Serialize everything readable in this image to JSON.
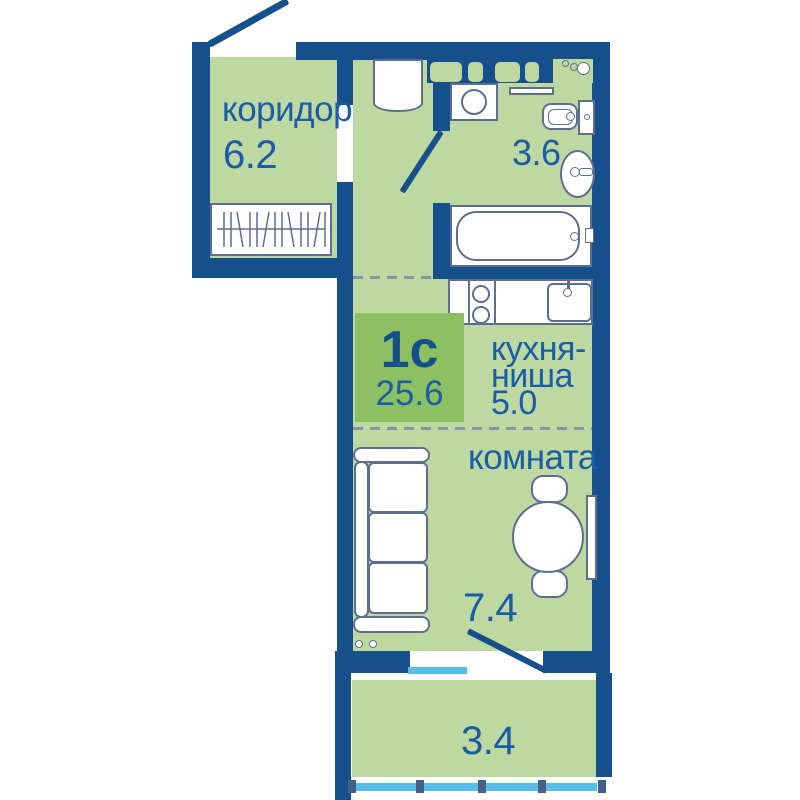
{
  "title_badge": {
    "plan_type": "1с",
    "total_area": "25.6"
  },
  "rooms": {
    "corridor": {
      "label": "коридор",
      "area": "6.2"
    },
    "bathroom": {
      "area": "3.6"
    },
    "kitchen_niche": {
      "label_line1": "кухня-",
      "label_line2": "ниша",
      "area": "5.0"
    },
    "room": {
      "label": "комната",
      "area": "7.4"
    },
    "balcony": {
      "area": "3.4"
    }
  },
  "colors": {
    "wall": "#15508C",
    "floor_fill": "#BDD8A1",
    "badge_fill": "#8CC063",
    "label_text": "#1B5CA6",
    "fixture_outline": "#5E6E90",
    "glazing_blue": "#56BDE9",
    "glazing_post": "#44608A",
    "zone_dash": "#8795A6"
  }
}
